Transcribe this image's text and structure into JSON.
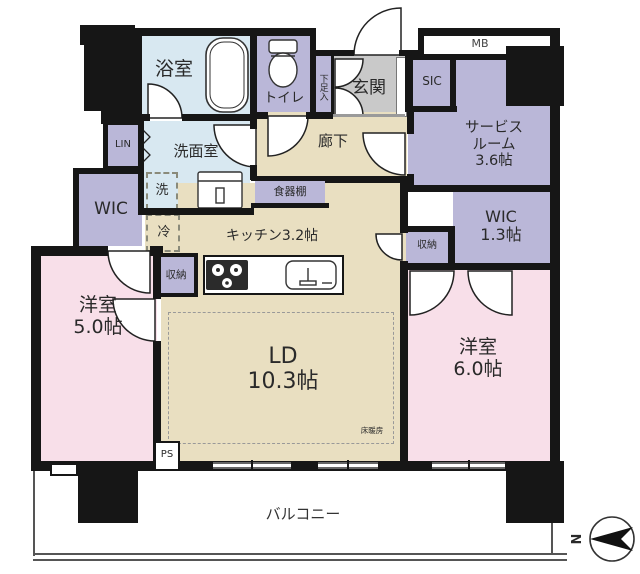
{
  "labels": {
    "bathroom": "浴室",
    "toilet": "トイレ",
    "shoe_box": "下足入",
    "entrance": "玄関",
    "meter_box": "MB",
    "sic": "SIC",
    "service_room": [
      "サービス",
      "ルーム",
      "3.6帖"
    ],
    "wic_right": [
      "WIC",
      "1.3帖"
    ],
    "storage_right": "収納",
    "hallway": "廊下",
    "washroom": "洗面室",
    "washer": "洗",
    "linen": "LIN",
    "wic_left": "WIC",
    "fridge": "冷",
    "cupboard": "食器棚",
    "kitchen": "キッチン3.2帖",
    "storage_left": "収納",
    "living_dining": [
      "LD",
      "10.3帖"
    ],
    "floor_heating": "床暖房",
    "bedroom_left": [
      "洋室",
      "5.0帖"
    ],
    "bedroom_right": [
      "洋室",
      "6.0帖"
    ],
    "pipe_space": "PS",
    "balcony": "バルコニー",
    "north": "N"
  },
  "colors": {
    "wall": "#161616",
    "water": "#d8e8f1",
    "closet": "#bab7d8",
    "wood": "#e9dfc1",
    "bedroom": "#f8dfe9",
    "entrance_tile": "#c9c9c9"
  }
}
